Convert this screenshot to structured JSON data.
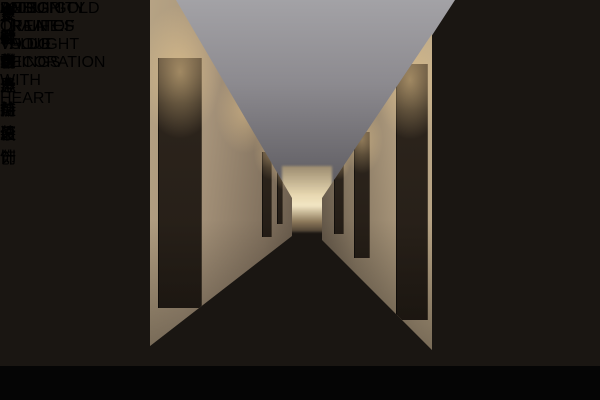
{
  "scene": {
    "room_sign_number": "3003",
    "colors": {
      "near_left_wall": "#57483a",
      "near_right_wall": "#655b4f",
      "ceiling": "#8c8a8f",
      "carpet_base": "#2c333e",
      "sign_teal": "#2f8a67",
      "artwork_red": "#c25430",
      "warm_light": "#f0ce92"
    }
  },
  "watermark": {
    "brand_cn": "金思路",
    "subtitle_cn": "安徽省十佳设计"
  },
  "branding_bar": {
    "slogan_left_1": "十七年坚持原创",
    "slogan_left_2": "紧跟世界前沿",
    "value_cn": "设计创造价值",
    "value_en": "DESIGN CREATES VALUE",
    "company_cn": "安徽金思路装饰",
    "company_en": "ANHUI GOLD TRAIN OF THOUGHT DECORATION",
    "motto_en": "INTEGRITY OF LIFE TO DO THINGS WITH HEART",
    "accent_color": "#b9c93f"
  }
}
